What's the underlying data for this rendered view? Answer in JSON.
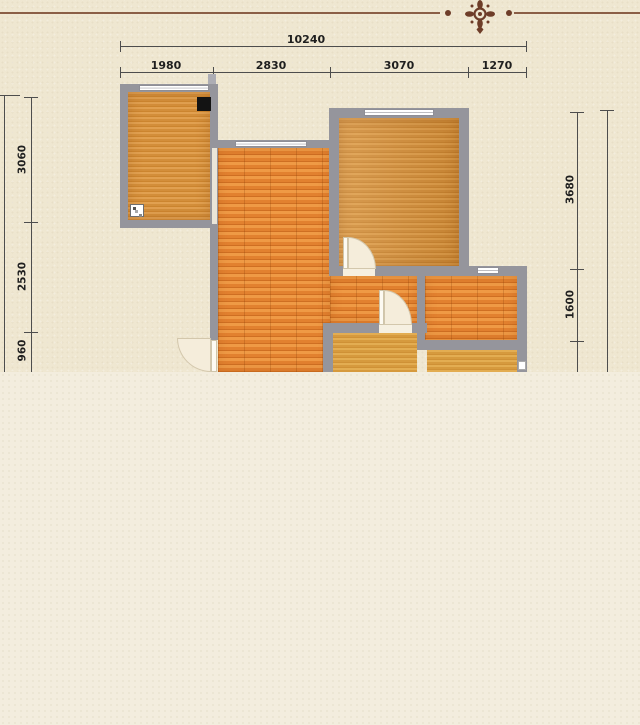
{
  "icons": {
    "divider": "floral-ornament-icon"
  },
  "dimensions": {
    "top_total": {
      "label": "10240"
    },
    "top_segments": [
      {
        "label": "1980"
      },
      {
        "label": "2830"
      },
      {
        "label": "3070"
      },
      {
        "label": "1270"
      }
    ],
    "left_segments": [
      {
        "label": "3060"
      },
      {
        "label": "2530"
      },
      {
        "label": "960"
      }
    ],
    "right_segments": [
      {
        "label": "3680"
      },
      {
        "label": "1600"
      }
    ]
  },
  "colors": {
    "wall": "#95959c",
    "floor_golden": "#d89440",
    "floor_plank": "#e28030",
    "background_top": "#efe7d1",
    "background_bottom": "#f3edde",
    "ornament": "#6e3d28",
    "rule": "#8a5e45",
    "dimension_line": "#4d4d4d"
  }
}
